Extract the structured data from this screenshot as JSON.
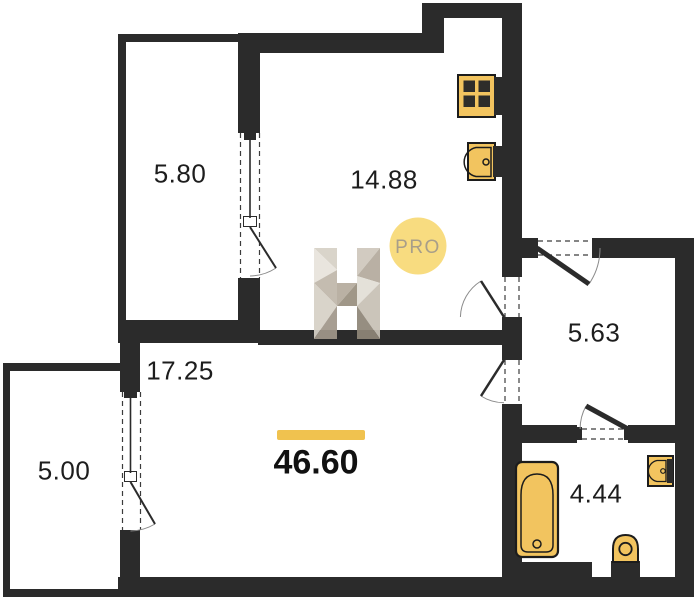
{
  "plan_type": "apartment-floor-plan",
  "total_area": "46.60",
  "rooms": {
    "loggia_top": "5.80",
    "kitchen": "14.88",
    "hallway": "5.63",
    "living": "17.25",
    "balcony": "5.00",
    "bathroom": "4.44"
  },
  "watermark": {
    "letter": "H",
    "badge": "PRO"
  },
  "fixtures": [
    "stove-icon",
    "kitchen-sink-icon",
    "bathtub-icon",
    "washbasin-icon",
    "toilet-icon"
  ],
  "colors": {
    "wall": "#2b2b2b",
    "fixture_fill": "#f2c45f",
    "accent_bar": "#f0c24f",
    "badge_fill": "#f8da79",
    "badge_text": "#a89e89",
    "label_text": "#1d1d1d"
  }
}
